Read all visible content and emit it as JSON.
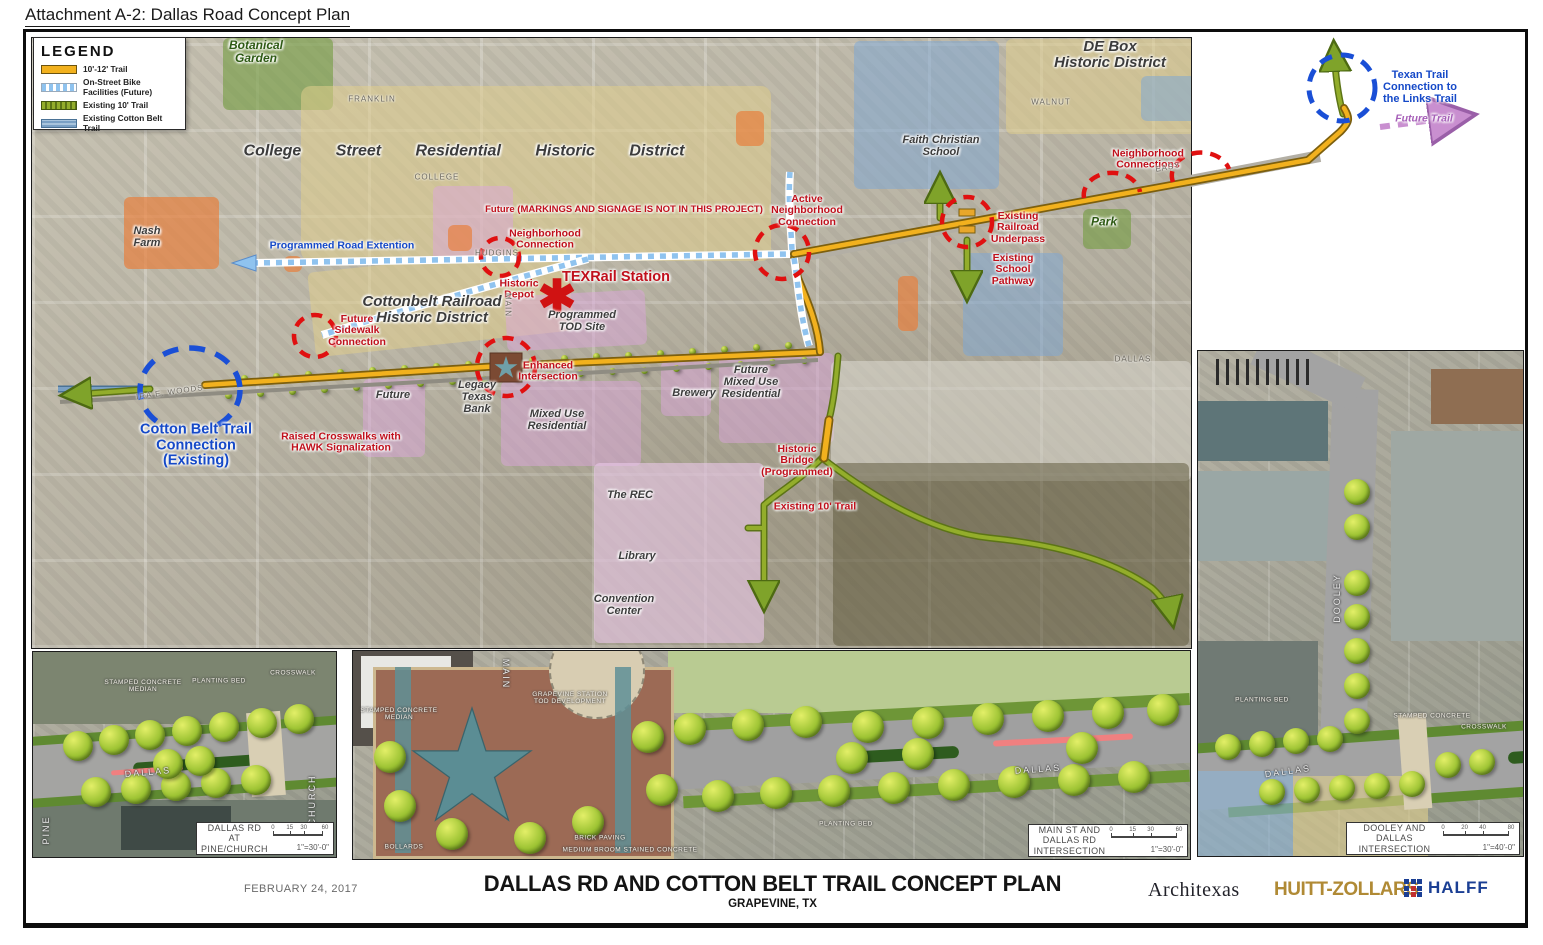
{
  "attachment_title": "Attachment A-2: Dallas Road Concept Plan",
  "legend": {
    "title": "LEGEND",
    "items": [
      {
        "label": "10'-12' Trail",
        "type": "trail-10-12",
        "color": "#f2b11e"
      },
      {
        "label": "On-Street Bike Facilities (Future)",
        "type": "bike-future",
        "color": "#8fc3ef"
      },
      {
        "label": "Existing 10' Trail",
        "type": "existing-10",
        "color": "#93ad2b"
      },
      {
        "label": "Existing Cotton Belt Trail",
        "type": "cotton-belt",
        "color": "#7aa0c4"
      }
    ]
  },
  "map": {
    "labels": [
      {
        "id": "botanical-garden",
        "text": "Botanical\nGarden",
        "x": 256,
        "y": 52,
        "cls": "green-lbl"
      },
      {
        "id": "college-street-district",
        "text": "College   Street   Residential   Historic   District",
        "x": 464,
        "y": 151,
        "cls": "district wide"
      },
      {
        "id": "nash-farm",
        "text": "Nash\nFarm",
        "x": 147,
        "y": 238,
        "cls": "district"
      },
      {
        "id": "programmed-road-extention",
        "text": "Programmed Road Extention",
        "x": 342,
        "y": 246,
        "cls": "blue",
        "size": "10.5"
      },
      {
        "id": "future-markings-note",
        "text": "Future (MARKINGS AND SIGNAGE IS NOT IN THIS PROJECT)",
        "x": 624,
        "y": 210,
        "cls": "red sm"
      },
      {
        "id": "neighborhood-connection",
        "text": "Neighborhood\nConnection",
        "x": 545,
        "y": 240,
        "cls": "red"
      },
      {
        "id": "historic-depot",
        "text": "Historic\nDepot",
        "x": 519,
        "y": 290,
        "cls": "red"
      },
      {
        "id": "texrail-station",
        "text": "TEXRail Station",
        "x": 616,
        "y": 278,
        "cls": "red lg"
      },
      {
        "id": "texrail-asterisk",
        "text": "✱",
        "x": 557,
        "y": 297,
        "cls": "asterisk"
      },
      {
        "id": "cottonbelt-railroad-district",
        "text": "Cottonbelt Railroad\nHistoric District",
        "x": 432,
        "y": 310,
        "cls": "district lg"
      },
      {
        "id": "programmed-tod-site",
        "text": "Programmed\nTOD Site",
        "x": 582,
        "y": 322,
        "cls": "district"
      },
      {
        "id": "active-neighborhood-connection",
        "text": "Active\nNeighborhood\nConnection",
        "x": 807,
        "y": 211,
        "cls": "red"
      },
      {
        "id": "de-box-district",
        "text": "DE Box\nHistoric District",
        "x": 1110,
        "y": 55,
        "cls": "district lg"
      },
      {
        "id": "faith-christian-school",
        "text": "Faith Christian\nSchool",
        "x": 941,
        "y": 147,
        "cls": "district"
      },
      {
        "id": "neighborhood-connections",
        "text": "Neighborhood\nConnections",
        "x": 1148,
        "y": 160,
        "cls": "red"
      },
      {
        "id": "existing-railroad-underpass",
        "text": "Existing\nRailroad\nUnderpass",
        "x": 1018,
        "y": 228,
        "cls": "red"
      },
      {
        "id": "existing-school-pathway",
        "text": "Existing\nSchool\nPathway",
        "x": 1013,
        "y": 270,
        "cls": "red"
      },
      {
        "id": "park",
        "text": "Park",
        "x": 1104,
        "y": 222,
        "cls": "green-lbl"
      },
      {
        "id": "texan-trail-connection",
        "text": "Texan Trail\nConnection to\nthe Links Trail",
        "x": 1420,
        "y": 88,
        "cls": "blue"
      },
      {
        "id": "future-trail",
        "text": "Future Trail",
        "x": 1424,
        "y": 119,
        "cls": "purple"
      },
      {
        "id": "cotton-belt-trail-connection",
        "text": "Cotton Belt Trail\nConnection\n(Existing)",
        "x": 196,
        "y": 446,
        "cls": "blue lg"
      },
      {
        "id": "future-sidewalk-connection",
        "text": "Future\nSidewalk\nConnection",
        "x": 357,
        "y": 331,
        "cls": "red"
      },
      {
        "id": "raised-crosswalks-hawk",
        "text": "Raised Crosswalks with\nHAWK Signalization",
        "x": 341,
        "y": 443,
        "cls": "red"
      },
      {
        "id": "future-building",
        "text": "Future",
        "x": 393,
        "y": 396,
        "cls": "district"
      },
      {
        "id": "legacy-texas-bank",
        "text": "Legacy\nTexas\nBank",
        "x": 477,
        "y": 398,
        "cls": "district"
      },
      {
        "id": "enhanced-intersection",
        "text": "Enhanced\nIntersection",
        "x": 548,
        "y": 372,
        "cls": "red"
      },
      {
        "id": "mixed-use-residential",
        "text": "Mixed Use\nResidential",
        "x": 557,
        "y": 421,
        "cls": "district"
      },
      {
        "id": "brewery",
        "text": "Brewery",
        "x": 694,
        "y": 394,
        "cls": "district"
      },
      {
        "id": "future-mixed-use-residential",
        "text": "Future\nMixed Use\nResidential",
        "x": 751,
        "y": 383,
        "cls": "district"
      },
      {
        "id": "historic-bridge-programmed",
        "text": "Historic\nBridge\n(Programmed)",
        "x": 797,
        "y": 461,
        "cls": "red"
      },
      {
        "id": "the-rec",
        "text": "The REC",
        "x": 630,
        "y": 496,
        "cls": "district"
      },
      {
        "id": "library",
        "text": "Library",
        "x": 637,
        "y": 557,
        "cls": "district"
      },
      {
        "id": "convention-center",
        "text": "Convention\nCenter",
        "x": 624,
        "y": 606,
        "cls": "district"
      },
      {
        "id": "existing-10-trail",
        "text": "Existing 10' Trail",
        "x": 815,
        "y": 507,
        "cls": "red"
      },
      {
        "id": "street-ira-e-woods",
        "text": "IRA E. WOODS",
        "x": 170,
        "y": 393,
        "cls": "street",
        "rot": -8
      },
      {
        "id": "street-hudgins",
        "text": "HUDGINS",
        "x": 497,
        "y": 254,
        "cls": "street"
      },
      {
        "id": "street-college",
        "text": "COLLEGE",
        "x": 437,
        "y": 178,
        "cls": "street"
      },
      {
        "id": "street-franklin",
        "text": "FRANKLIN",
        "x": 372,
        "y": 100,
        "cls": "street"
      },
      {
        "id": "street-walnut",
        "text": "WALNUT",
        "x": 1051,
        "y": 103,
        "cls": "street"
      },
      {
        "id": "street-easy",
        "text": "EASY",
        "x": 1168,
        "y": 168,
        "cls": "street",
        "rot": -10
      },
      {
        "id": "street-dallas",
        "text": "DALLAS",
        "x": 1133,
        "y": 360,
        "cls": "street"
      },
      {
        "id": "street-main",
        "text": "MAIN",
        "x": 507,
        "y": 305,
        "cls": "street",
        "rot": 90
      }
    ]
  },
  "inset_labels": [
    {
      "id": "pine-church-stamped-median",
      "text": "STAMPED CONCRETE\nMEDIAN",
      "x": 143,
      "y": 686,
      "cls": "tiny"
    },
    {
      "id": "pine-church-planting-bed",
      "text": "PLANTING BED",
      "x": 219,
      "y": 681,
      "cls": "tiny"
    },
    {
      "id": "pine-church-crosswalk",
      "text": "CROSSWALK",
      "x": 293,
      "y": 673,
      "cls": "tiny"
    },
    {
      "id": "pine-church-street-dallas",
      "text": "DALLAS",
      "x": 148,
      "y": 773,
      "cls": "street-white",
      "rot": -5
    },
    {
      "id": "pine-church-street-pine",
      "text": "PINE",
      "x": 47,
      "y": 830,
      "cls": "street-white",
      "rot": -90
    },
    {
      "id": "pine-church-street-church",
      "text": "CHURCH",
      "x": 313,
      "y": 800,
      "cls": "street-white",
      "rot": -90
    },
    {
      "id": "main-dallas-grapevine-station",
      "text": "GRAPEVINE STATION\nTOD DEVELOPMENT",
      "x": 570,
      "y": 698,
      "cls": "tiny"
    },
    {
      "id": "main-dallas-street-main",
      "text": "MAIN",
      "x": 505,
      "y": 674,
      "cls": "street-white",
      "rot": 90
    },
    {
      "id": "main-dallas-street-dallas",
      "text": "DALLAS",
      "x": 1038,
      "y": 770,
      "cls": "street-white",
      "rot": -4
    },
    {
      "id": "main-dallas-stamped-median",
      "text": "STAMPED CONCRETE\nMEDIAN",
      "x": 399,
      "y": 714,
      "cls": "tiny"
    },
    {
      "id": "main-dallas-bollards",
      "text": "BOLLARDS",
      "x": 404,
      "y": 847,
      "cls": "tiny"
    },
    {
      "id": "main-dallas-brick-paving",
      "text": "BRICK PAVING",
      "x": 600,
      "y": 838,
      "cls": "tiny"
    },
    {
      "id": "main-dallas-stained-concrete",
      "text": "MEDIUM BROOM STAINED CONCRETE",
      "x": 630,
      "y": 850,
      "cls": "tiny"
    },
    {
      "id": "main-dallas-planting-bed",
      "text": "PLANTING BED",
      "x": 846,
      "y": 824,
      "cls": "tiny"
    },
    {
      "id": "dooley-planting-bed",
      "text": "PLANTING BED",
      "x": 1262,
      "y": 700,
      "cls": "tiny"
    },
    {
      "id": "dooley-stamped-concrete",
      "text": "STAMPED CONCRETE",
      "x": 1432,
      "y": 716,
      "cls": "tiny"
    },
    {
      "id": "dooley-crosswalk",
      "text": "CROSSWALK",
      "x": 1484,
      "y": 727,
      "cls": "tiny"
    },
    {
      "id": "dooley-street-dooley",
      "text": "DOOLEY",
      "x": 1338,
      "y": 598,
      "cls": "street-white",
      "rot": -90
    },
    {
      "id": "dooley-street-dallas",
      "text": "DALLAS",
      "x": 1288,
      "y": 772,
      "cls": "street-white",
      "rot": -8
    }
  ],
  "insets": [
    {
      "caption": "DALLAS RD AT PINE/CHURCH",
      "scale": "1\"=30'-0\"",
      "scale_ticks": [
        "0",
        "15",
        "30",
        "60"
      ]
    },
    {
      "caption": "MAIN ST AND DALLAS RD INTERSECTION",
      "scale": "1\"=30'-0\"",
      "scale_ticks": [
        "0",
        "15",
        "30",
        "60"
      ]
    },
    {
      "caption": "DOOLEY AND DALLAS INTERSECTION",
      "scale": "1\"=40'-0\"",
      "scale_ticks": [
        "0",
        "20",
        "40",
        "80"
      ]
    }
  ],
  "titleblock": {
    "date": "FEBRUARY 24, 2017",
    "title": "DALLAS RD AND COTTON BELT TRAIL CONCEPT PLAN",
    "subtitle": "GRAPEVINE, TX",
    "logos": [
      {
        "name": "Architexas"
      },
      {
        "name": "HUITT-ZOLLARS"
      },
      {
        "name": "HALFF"
      }
    ]
  },
  "colors": {
    "trail": "#f2b11e",
    "bike_future": "#8fc3ef",
    "existing_trail": "#93ad2b",
    "cotton_belt": "#7aa0c4",
    "annotation_red": "#d01212",
    "annotation_blue": "#1a4fd6",
    "future_trail_purple": "#c98fd0"
  }
}
